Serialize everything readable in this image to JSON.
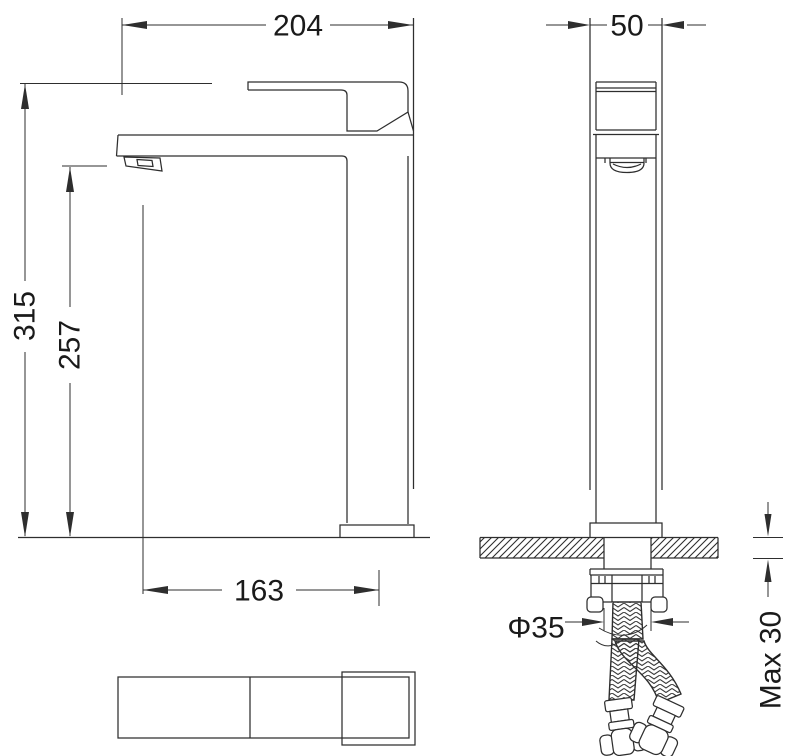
{
  "drawing": {
    "background": "#ffffff",
    "line_color": "#2e2e2e",
    "text_color": "#1a1a1a"
  },
  "dimensions": {
    "total_width": "204",
    "depth": "50",
    "total_height": "315",
    "spout_height": "257",
    "spout_reach": "163",
    "hole_diameter": "Φ35",
    "max_thickness": "Max 30"
  }
}
